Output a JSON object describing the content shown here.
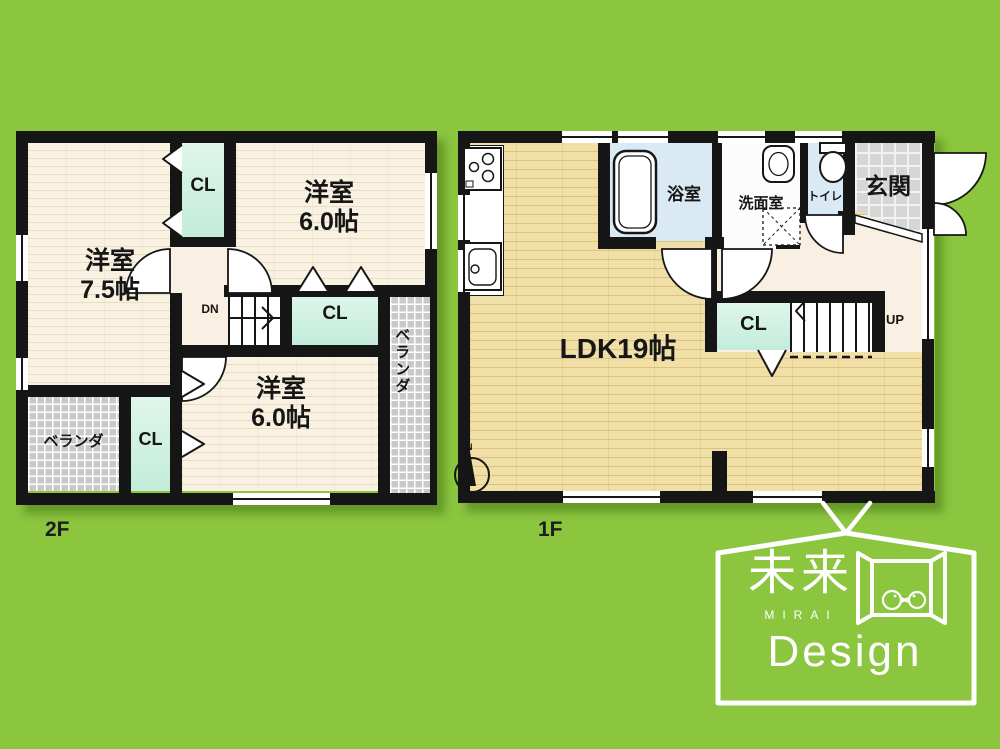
{
  "floor2": {
    "label": "2F",
    "room75": {
      "name": "洋室",
      "size": "7.5帖"
    },
    "room60_top": {
      "name": "洋室",
      "size": "6.0帖"
    },
    "room60_bottom": {
      "name": "洋室",
      "size": "6.0帖"
    },
    "closet_top": "CL",
    "closet_mid": "CL",
    "closet_bottom": "CL",
    "stairs_dn": "DN",
    "veranda_left": "ベランダ",
    "veranda_right": "ベランダ"
  },
  "floor1": {
    "label": "1F",
    "ldk": "LDK19帖",
    "bath": "浴室",
    "washroom": "洗面室",
    "toilet": "トイレ",
    "entrance": "玄関",
    "closet": "CL",
    "stairs_up": "UP"
  },
  "compass": {
    "north": "N"
  },
  "logo": {
    "kanji": "未来",
    "romaji": "MIRAI",
    "word": "Design"
  },
  "colors": {
    "background": "#8CC63F",
    "wall": "#161616",
    "floor_cream": "#F8F1E1",
    "floor_wood": "#EFDCA2",
    "hall_cream": "#F9EFE2",
    "closet_mint": "#CBEEDF",
    "wet_blue": "#DAEAF5",
    "entrance_tile": "#D6D6D6",
    "veranda_gray": "#C9C9C9",
    "logo_white": "#FFFFFF"
  }
}
